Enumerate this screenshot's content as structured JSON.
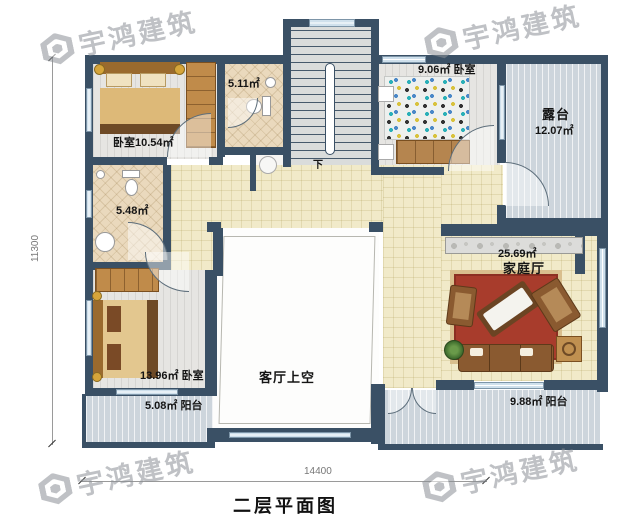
{
  "brand": {
    "watermark_text": "宇鸿建筑"
  },
  "plan": {
    "title": "二层平面图",
    "dim_width": "14400",
    "dim_height": "11300",
    "labels": {
      "bedroom_tl": "卧室10.54㎡",
      "bath_top": "5.11㎡",
      "bedroom_tr": "9.06㎡ 卧室",
      "terrace_name": "露台",
      "terrace_area": "12.07㎡",
      "bath_left": "5.48㎡",
      "family_area": "25.69㎡",
      "family_name": "家庭厅",
      "bedroom_bl": "13.96㎡ 卧室",
      "balcony_left": "5.08㎡ 阳台",
      "living_void": "客厅上空",
      "balcony_right": "9.88㎡ 阳台",
      "stairs_down": "下"
    }
  },
  "colors": {
    "wall": "#3a5065",
    "floor_tile_yellow": "#f1eac9",
    "floor_wood_gray": "#e6e5e2",
    "floor_balcony_blue": "#cdd5dc",
    "floor_bath_beige": "#ead9bd",
    "carpet_red": "#a83c2c",
    "furniture_wood": "#c08b4a"
  }
}
